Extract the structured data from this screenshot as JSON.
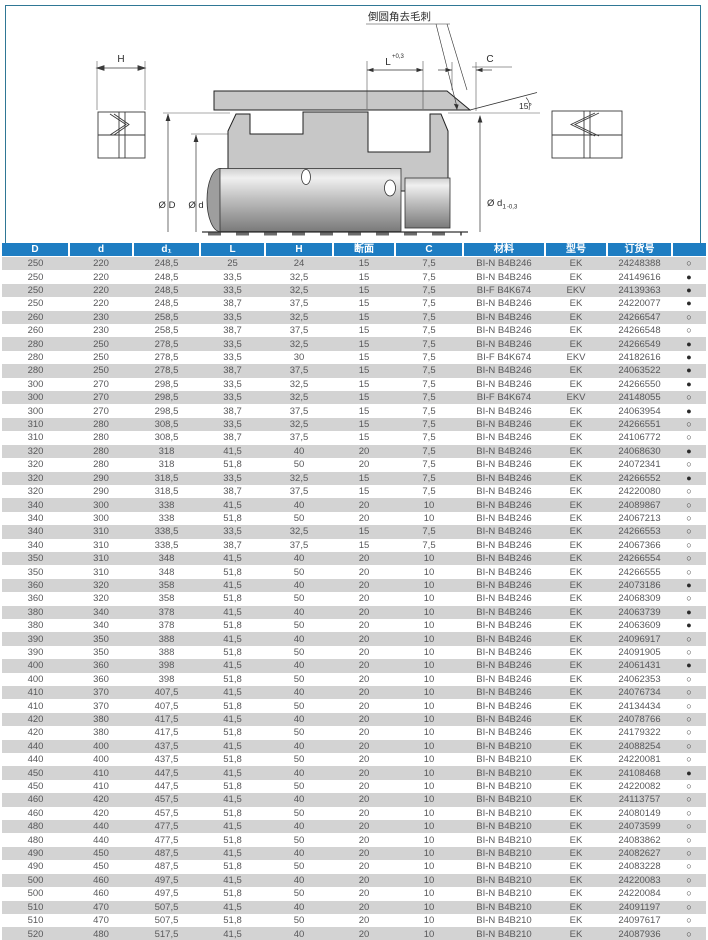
{
  "diagram": {
    "callout": "倒圆角去毛刺",
    "h_label": "H",
    "l_label": "L",
    "l_tolerance": "+0,3",
    "c_label": "C",
    "angle_label": "15°",
    "outer_dia_label": "Ø D",
    "rod_dia_label": "Ø d",
    "groove_dia_label": "Ø d",
    "groove_dia_sub": "1",
    "groove_dia_tolerance": "-0,3"
  },
  "colors": {
    "header_blue": "#1e7dc2",
    "row_gray": "#d3d3d3",
    "page_border_teal": "#2f7795",
    "part_gray": "#c7c7c7"
  },
  "table": {
    "columns": [
      "D",
      "d",
      "d₁",
      "L",
      "H",
      "断面",
      "C",
      "材料",
      "型号",
      "订货号",
      ""
    ],
    "column_widths": [
      67,
      64,
      67,
      65,
      68,
      62,
      68,
      82,
      62,
      65,
      34
    ],
    "rows": [
      [
        "250",
        "220",
        "248,5",
        "25",
        "24",
        "15",
        "7,5",
        "BI-N B4B246",
        "EK",
        "24248388",
        "○"
      ],
      [
        "250",
        "220",
        "248,5",
        "33,5",
        "32,5",
        "15",
        "7,5",
        "BI-N B4B246",
        "EK",
        "24149616",
        "●"
      ],
      [
        "250",
        "220",
        "248,5",
        "33,5",
        "32,5",
        "15",
        "7,5",
        "BI-F B4K674",
        "EKV",
        "24139363",
        "●"
      ],
      [
        "250",
        "220",
        "248,5",
        "38,7",
        "37,5",
        "15",
        "7,5",
        "BI-N B4B246",
        "EK",
        "24220077",
        "●"
      ],
      [
        "260",
        "230",
        "258,5",
        "33,5",
        "32,5",
        "15",
        "7,5",
        "BI-N B4B246",
        "EK",
        "24266547",
        "○"
      ],
      [
        "260",
        "230",
        "258,5",
        "38,7",
        "37,5",
        "15",
        "7,5",
        "BI-N B4B246",
        "EK",
        "24266548",
        "○"
      ],
      [
        "280",
        "250",
        "278,5",
        "33,5",
        "32,5",
        "15",
        "7,5",
        "BI-N B4B246",
        "EK",
        "24266549",
        "●"
      ],
      [
        "280",
        "250",
        "278,5",
        "33,5",
        "30",
        "15",
        "7,5",
        "BI-F B4K674",
        "EKV",
        "24182616",
        "●"
      ],
      [
        "280",
        "250",
        "278,5",
        "38,7",
        "37,5",
        "15",
        "7,5",
        "BI-N B4B246",
        "EK",
        "24063522",
        "●"
      ],
      [
        "300",
        "270",
        "298,5",
        "33,5",
        "32,5",
        "15",
        "7,5",
        "BI-N B4B246",
        "EK",
        "24266550",
        "●"
      ],
      [
        "300",
        "270",
        "298,5",
        "33,5",
        "32,5",
        "15",
        "7,5",
        "BI-F B4K674",
        "EKV",
        "24148055",
        "○"
      ],
      [
        "300",
        "270",
        "298,5",
        "38,7",
        "37,5",
        "15",
        "7,5",
        "BI-N B4B246",
        "EK",
        "24063954",
        "●"
      ],
      [
        "310",
        "280",
        "308,5",
        "33,5",
        "32,5",
        "15",
        "7,5",
        "BI-N B4B246",
        "EK",
        "24266551",
        "○"
      ],
      [
        "310",
        "280",
        "308,5",
        "38,7",
        "37,5",
        "15",
        "7,5",
        "BI-N B4B246",
        "EK",
        "24106772",
        "○"
      ],
      [
        "320",
        "280",
        "318",
        "41,5",
        "40",
        "20",
        "7,5",
        "BI-N B4B246",
        "EK",
        "24068630",
        "●"
      ],
      [
        "320",
        "280",
        "318",
        "51,8",
        "50",
        "20",
        "7,5",
        "BI-N B4B246",
        "EK",
        "24072341",
        "○"
      ],
      [
        "320",
        "290",
        "318,5",
        "33,5",
        "32,5",
        "15",
        "7,5",
        "BI-N B4B246",
        "EK",
        "24266552",
        "●"
      ],
      [
        "320",
        "290",
        "318,5",
        "38,7",
        "37,5",
        "15",
        "7,5",
        "BI-N B4B246",
        "EK",
        "24220080",
        "○"
      ],
      [
        "340",
        "300",
        "338",
        "41,5",
        "40",
        "20",
        "10",
        "BI-N B4B246",
        "EK",
        "24089867",
        "○"
      ],
      [
        "340",
        "300",
        "338",
        "51,8",
        "50",
        "20",
        "10",
        "BI-N B4B246",
        "EK",
        "24067213",
        "○"
      ],
      [
        "340",
        "310",
        "338,5",
        "33,5",
        "32,5",
        "15",
        "7,5",
        "BI-N B4B246",
        "EK",
        "24266553",
        "○"
      ],
      [
        "340",
        "310",
        "338,5",
        "38,7",
        "37,5",
        "15",
        "7,5",
        "BI-N B4B246",
        "EK",
        "24067366",
        "○"
      ],
      [
        "350",
        "310",
        "348",
        "41,5",
        "40",
        "20",
        "10",
        "BI-N B4B246",
        "EK",
        "24266554",
        "○"
      ],
      [
        "350",
        "310",
        "348",
        "51,8",
        "50",
        "20",
        "10",
        "BI-N B4B246",
        "EK",
        "24266555",
        "○"
      ],
      [
        "360",
        "320",
        "358",
        "41,5",
        "40",
        "20",
        "10",
        "BI-N B4B246",
        "EK",
        "24073186",
        "●"
      ],
      [
        "360",
        "320",
        "358",
        "51,8",
        "50",
        "20",
        "10",
        "BI-N B4B246",
        "EK",
        "24068309",
        "○"
      ],
      [
        "380",
        "340",
        "378",
        "41,5",
        "40",
        "20",
        "10",
        "BI-N B4B246",
        "EK",
        "24063739",
        "●"
      ],
      [
        "380",
        "340",
        "378",
        "51,8",
        "50",
        "20",
        "10",
        "BI-N B4B246",
        "EK",
        "24063609",
        "●"
      ],
      [
        "390",
        "350",
        "388",
        "41,5",
        "40",
        "20",
        "10",
        "BI-N B4B246",
        "EK",
        "24096917",
        "○"
      ],
      [
        "390",
        "350",
        "388",
        "51,8",
        "50",
        "20",
        "10",
        "BI-N B4B246",
        "EK",
        "24091905",
        "○"
      ],
      [
        "400",
        "360",
        "398",
        "41,5",
        "40",
        "20",
        "10",
        "BI-N B4B246",
        "EK",
        "24061431",
        "●"
      ],
      [
        "400",
        "360",
        "398",
        "51,8",
        "50",
        "20",
        "10",
        "BI-N B4B246",
        "EK",
        "24062353",
        "○"
      ],
      [
        "410",
        "370",
        "407,5",
        "41,5",
        "40",
        "20",
        "10",
        "BI-N B4B246",
        "EK",
        "24076734",
        "○"
      ],
      [
        "410",
        "370",
        "407,5",
        "51,8",
        "50",
        "20",
        "10",
        "BI-N B4B246",
        "EK",
        "24134434",
        "○"
      ],
      [
        "420",
        "380",
        "417,5",
        "41,5",
        "40",
        "20",
        "10",
        "BI-N B4B246",
        "EK",
        "24078766",
        "○"
      ],
      [
        "420",
        "380",
        "417,5",
        "51,8",
        "50",
        "20",
        "10",
        "BI-N B4B246",
        "EK",
        "24179322",
        "○"
      ],
      [
        "440",
        "400",
        "437,5",
        "41,5",
        "40",
        "20",
        "10",
        "BI-N B4B210",
        "EK",
        "24088254",
        "○"
      ],
      [
        "440",
        "400",
        "437,5",
        "51,8",
        "50",
        "20",
        "10",
        "BI-N B4B210",
        "EK",
        "24220081",
        "○"
      ],
      [
        "450",
        "410",
        "447,5",
        "41,5",
        "40",
        "20",
        "10",
        "BI-N B4B210",
        "EK",
        "24108468",
        "●"
      ],
      [
        "450",
        "410",
        "447,5",
        "51,8",
        "50",
        "20",
        "10",
        "BI-N B4B210",
        "EK",
        "24220082",
        "○"
      ],
      [
        "460",
        "420",
        "457,5",
        "41,5",
        "40",
        "20",
        "10",
        "BI-N B4B210",
        "EK",
        "24113757",
        "○"
      ],
      [
        "460",
        "420",
        "457,5",
        "51,8",
        "50",
        "20",
        "10",
        "BI-N B4B210",
        "EK",
        "24080149",
        "○"
      ],
      [
        "480",
        "440",
        "477,5",
        "41,5",
        "40",
        "20",
        "10",
        "BI-N B4B210",
        "EK",
        "24073599",
        "○"
      ],
      [
        "480",
        "440",
        "477,5",
        "51,8",
        "50",
        "20",
        "10",
        "BI-N B4B210",
        "EK",
        "24083862",
        "○"
      ],
      [
        "490",
        "450",
        "487,5",
        "41,5",
        "40",
        "20",
        "10",
        "BI-N B4B210",
        "EK",
        "24082627",
        "○"
      ],
      [
        "490",
        "450",
        "487,5",
        "51,8",
        "50",
        "20",
        "10",
        "BI-N B4B210",
        "EK",
        "24083228",
        "○"
      ],
      [
        "500",
        "460",
        "497,5",
        "41,5",
        "40",
        "20",
        "10",
        "BI-N B4B210",
        "EK",
        "24220083",
        "○"
      ],
      [
        "500",
        "460",
        "497,5",
        "51,8",
        "50",
        "20",
        "10",
        "BI-N B4B210",
        "EK",
        "24220084",
        "○"
      ],
      [
        "510",
        "470",
        "507,5",
        "41,5",
        "40",
        "20",
        "10",
        "BI-N B4B210",
        "EK",
        "24091197",
        "○"
      ],
      [
        "510",
        "470",
        "507,5",
        "51,8",
        "50",
        "20",
        "10",
        "BI-N B4B210",
        "EK",
        "24097617",
        "○"
      ],
      [
        "520",
        "480",
        "517,5",
        "41,5",
        "40",
        "20",
        "10",
        "BI-N B4B210",
        "EK",
        "24087936",
        "○"
      ]
    ]
  }
}
